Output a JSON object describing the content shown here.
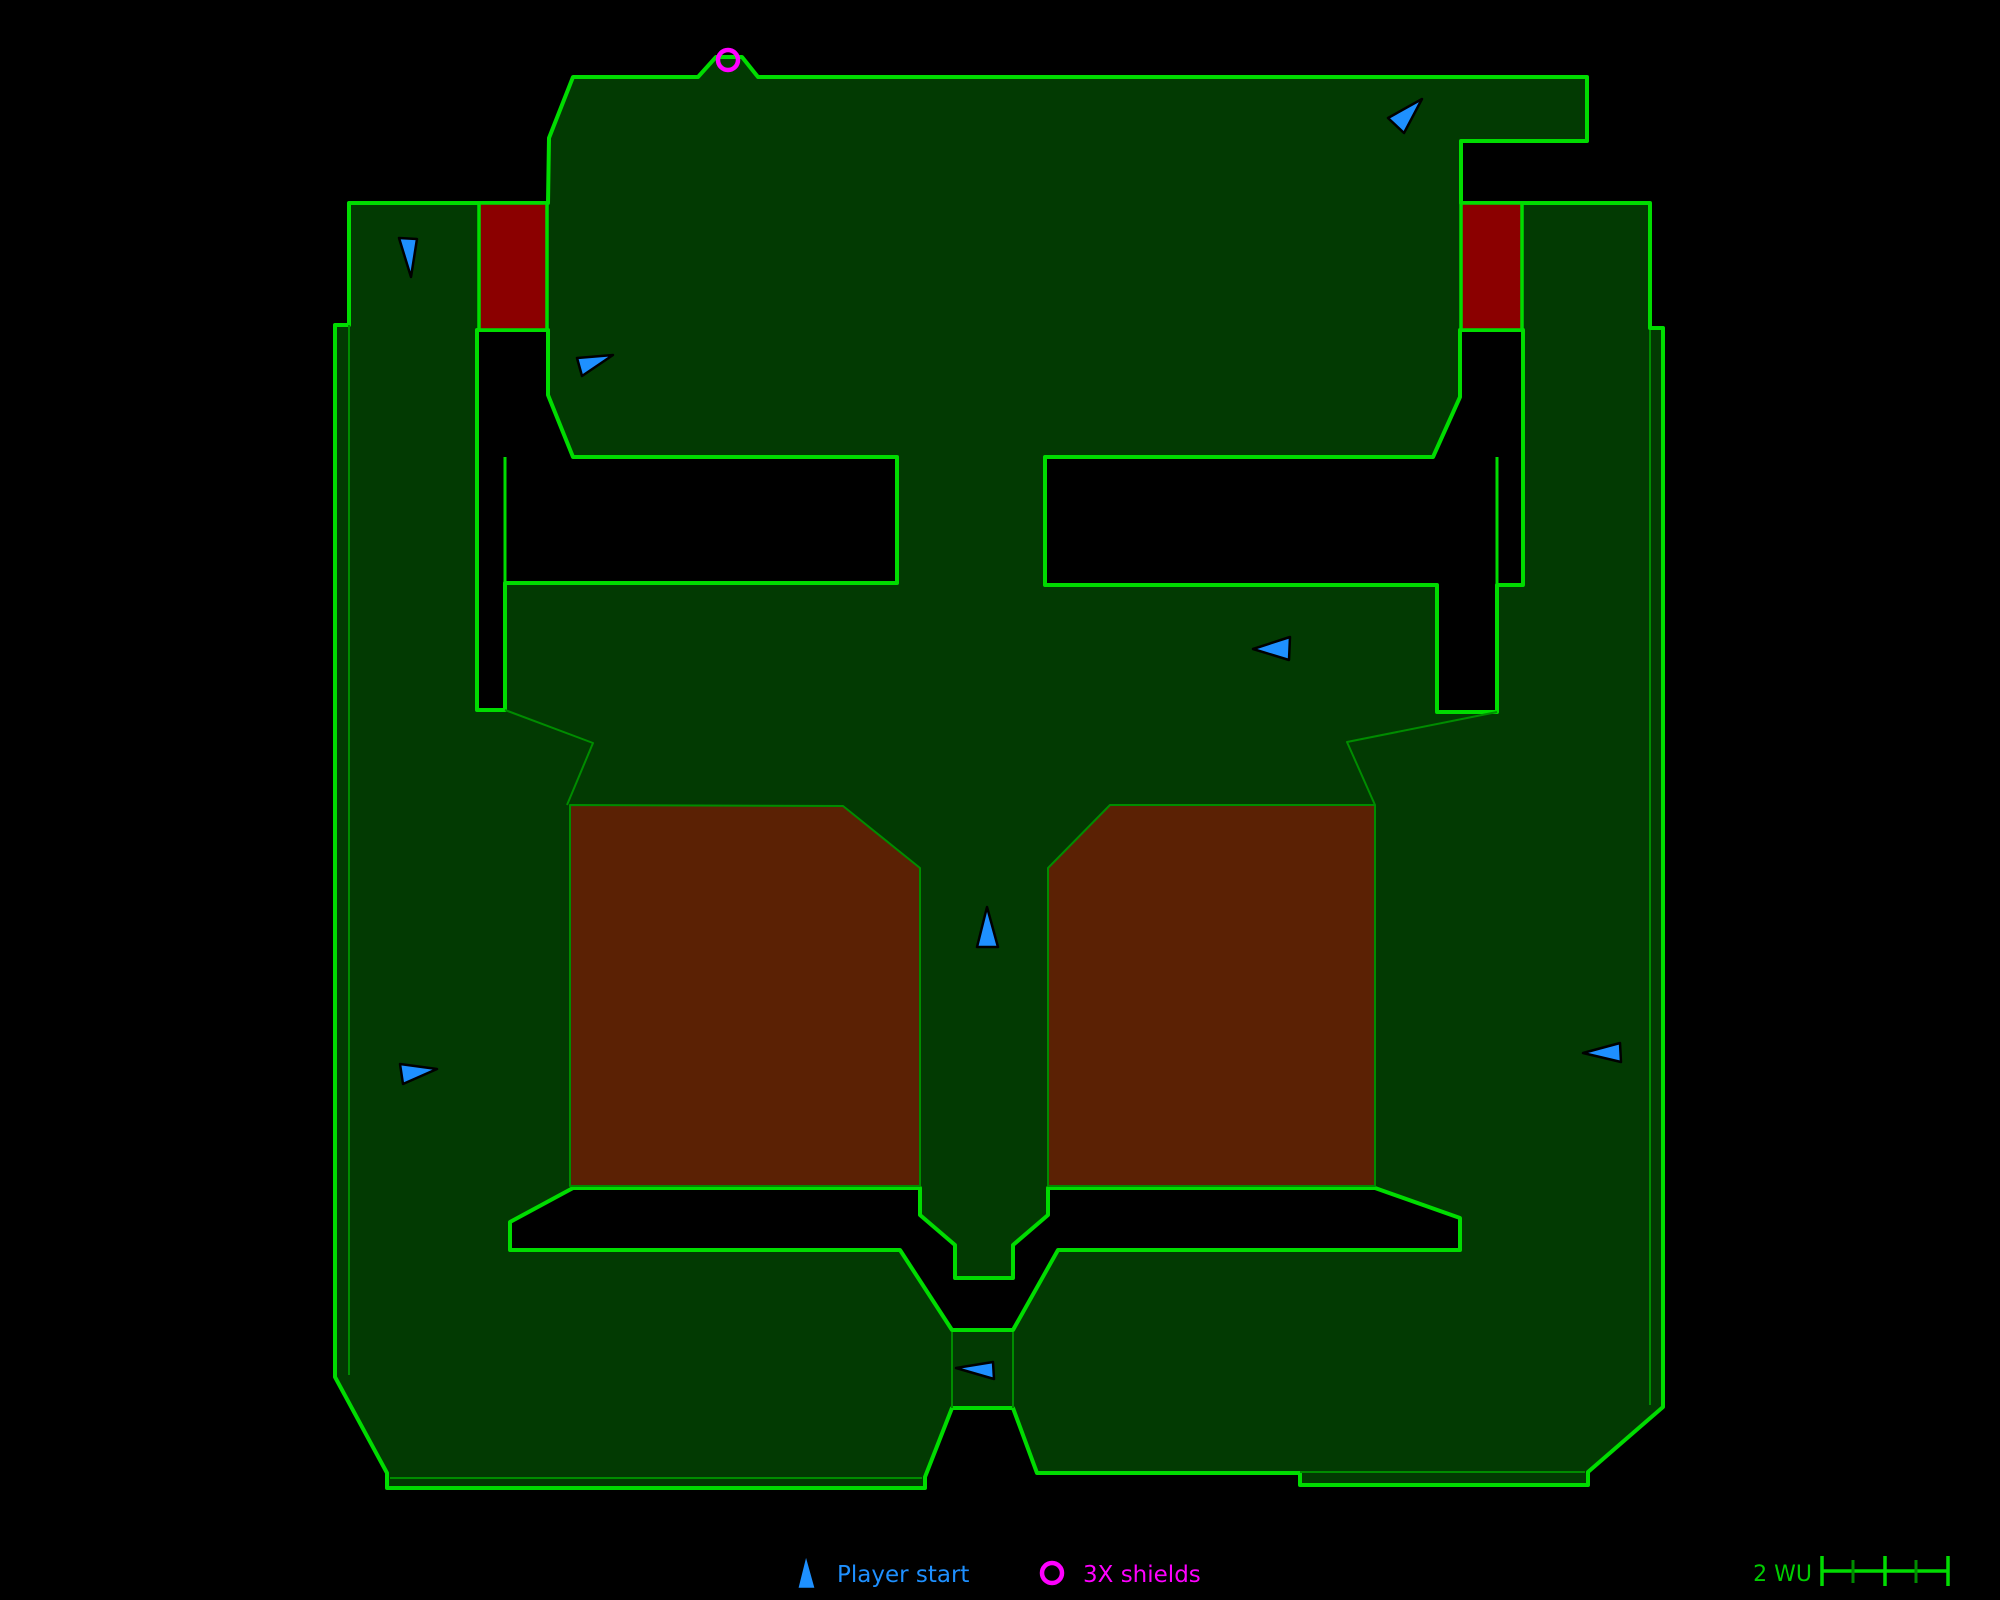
{
  "title": "Level map overview",
  "colors": {
    "background": "#000000",
    "floor": "#023A02",
    "outline": "#00DC00",
    "line_dim": "#008C00",
    "door_red": "#8B0000",
    "platform_brown": "#5B2104",
    "player_blue": "#1E90FF",
    "shield_magenta": "#FF00FF",
    "scale_text_green": "#00CC00"
  },
  "map": {
    "silhouette": "573,77 698,77 716,57 742,57 758,77 1587,77 1587,141 1461,141 1461,203 1650,203 1650,328 1663,328 1663,1407 1588,1472 1588,1485 1300,1485 1300,1473 1037,1473 1013,1408 952,1408 925,1477 925,1488 387,1488 387,1473 335,1377 335,325 349,325 349,203 548,203 549,138",
    "voids": [
      {
        "name": "void-upper-left",
        "points": "477,330 548,330 548,395 573,457 897,457 897,583 505,583 505,710 477,710"
      },
      {
        "name": "void-upper-right",
        "points": "1460,330 1523,330 1523,585 1497,585 1497,712 1437,712 1437,585 1045,585 1045,457 1433,457 1460,397"
      },
      {
        "name": "void-lower-channel",
        "points": "510,1222 573,1188 920,1188 920,1215 955,1245 955,1278 1013,1278 1013,1245 1048,1215 1048,1188 1375,1188 1460,1218 1460,1250 1058,1250 1013,1330 952,1330 900,1250 510,1250"
      }
    ],
    "red_doors": [
      {
        "name": "red-door-left",
        "x": 479,
        "y": 203,
        "w": 68,
        "h": 127
      },
      {
        "name": "red-door-right",
        "x": 1461,
        "y": 203,
        "w": 61,
        "h": 127
      }
    ],
    "platforms": [
      {
        "name": "platform-left",
        "points": "570,805 843,806 920,868 920,1186 570,1186"
      },
      {
        "name": "platform-right",
        "points": "1110,805 1375,805 1375,1186 1048,1186 1048,868"
      }
    ],
    "ridges": [
      {
        "points": "349,325 349,1375"
      },
      {
        "points": "505,710 593,743 567,805"
      },
      {
        "points": "1497,712 1347,742 1375,805"
      },
      {
        "points": "1650,330 1650,1405"
      },
      {
        "points": "390,1478 922,1478"
      },
      {
        "points": "1300,1472 1585,1472"
      },
      {
        "points": "952,1332 952,1408"
      },
      {
        "points": "1013,1332 1013,1408"
      }
    ],
    "walls": [
      {
        "points": "505,457 505,583"
      },
      {
        "points": "1497,457 1497,585"
      }
    ],
    "player_starts": [
      {
        "points": "399,238 417,239 411,277"
      },
      {
        "points": "577,358 613,355 582,376"
      },
      {
        "points": "1422,99 1388,118 1404,133"
      },
      {
        "points": "1290,637 1289,660 1253,649"
      },
      {
        "points": "987,907 977,947 998,947"
      },
      {
        "points": "400,1064 403,1084 437,1069"
      },
      {
        "points": "1620,1043 1621,1062 1583,1053"
      },
      {
        "points": "993,1362 994,1379 956,1368"
      }
    ],
    "shields": [
      {
        "cx": 728,
        "cy": 60,
        "r": 10
      }
    ]
  },
  "legend": {
    "player_start_label": "Player start",
    "shields_label": "3X shields",
    "marker_triangle": "806,1553 797,1589 816,1589",
    "marker_circle": {
      "cx": 1052,
      "cy": 1573,
      "r": 10
    }
  },
  "scale_bar": {
    "label": "2 WU",
    "line": {
      "x1": 1821,
      "y1": 1571,
      "x2": 1948,
      "y2": 1571
    },
    "major_ticks": [
      1822,
      1885,
      1948
    ],
    "minor_ticks": [
      1853,
      1916
    ],
    "major_top": 1556,
    "major_bottom": 1586,
    "minor_top": 1560,
    "minor_bottom": 1583
  }
}
